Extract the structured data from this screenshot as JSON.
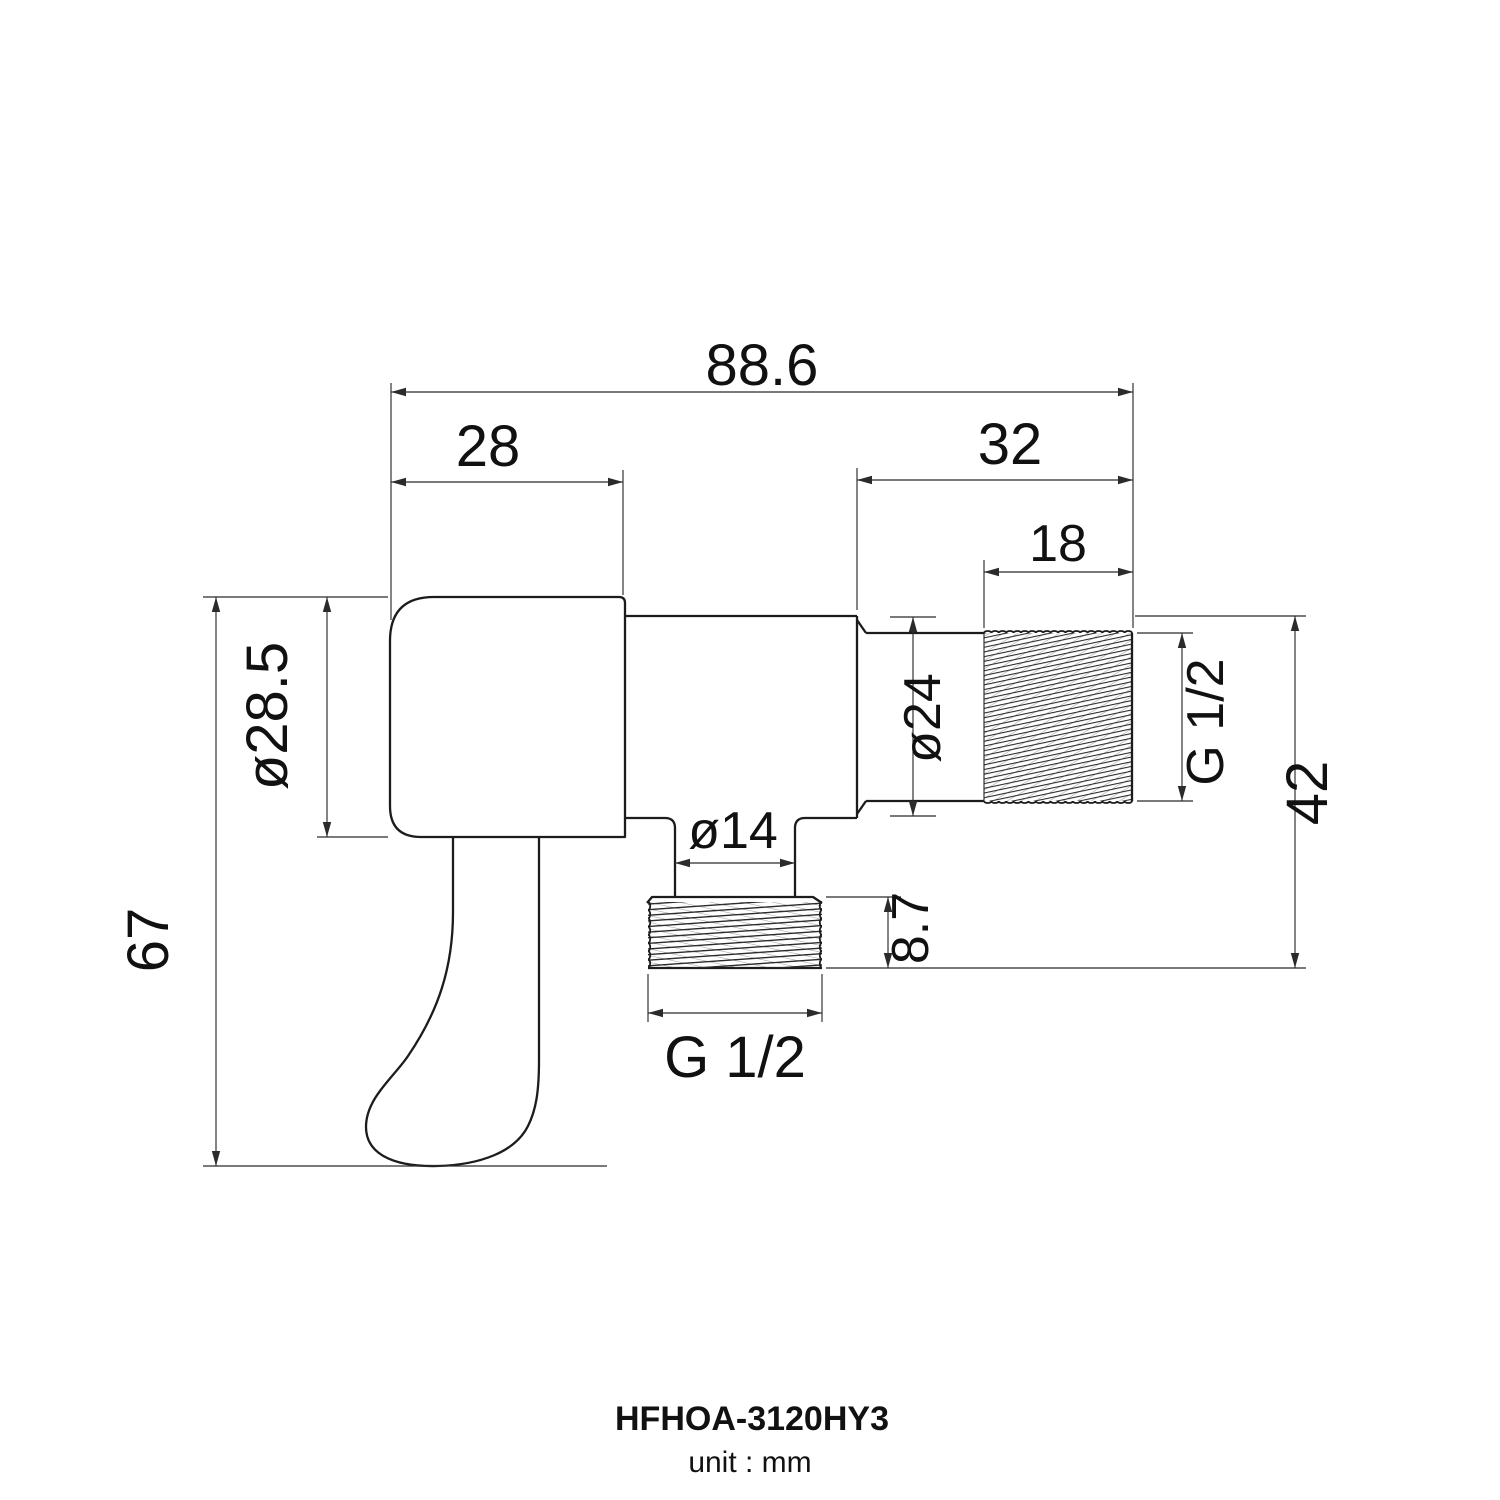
{
  "dimensions": {
    "overall_width": "88.6",
    "body_width": "28",
    "inlet_length": "32",
    "inlet_thread_length": "18",
    "body_diameter": "ø28.5",
    "overall_height": "67",
    "inlet_diameter": "ø24",
    "inlet_thread_spec": "G 1/2",
    "inlet_side_height": "42",
    "outlet_neck_diameter": "ø14",
    "outlet_thread_height": "8.7",
    "outlet_thread_spec": "G 1/2"
  },
  "footer": {
    "model": "HFHOA-3120HY3",
    "unit_note": "unit : mm"
  },
  "colors": {
    "background": "#ffffff",
    "outline": "#1c1c1c",
    "dimension_line": "#2b2b2b",
    "text": "#111111"
  }
}
